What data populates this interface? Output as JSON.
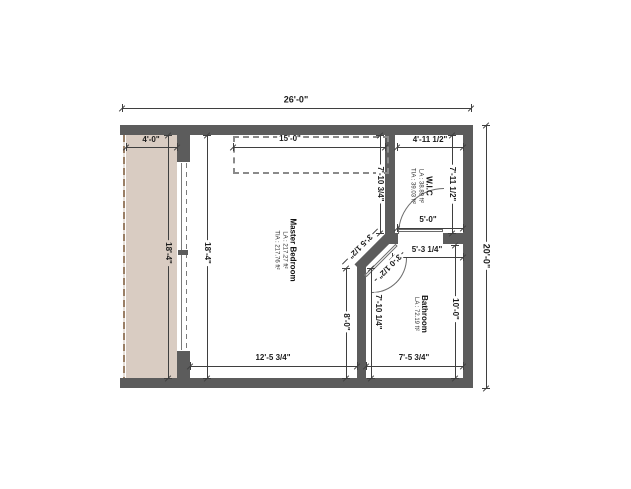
{
  "plan": {
    "canvas": {
      "w": 631,
      "h": 489
    },
    "colors": {
      "wall": "#5c5c5c",
      "balcony_fill": "#d9ccc2",
      "railing": "#9a7f66",
      "dim_line": "#3f3f3f",
      "text": "#1b1b1b",
      "background": "#ffffff"
    },
    "overall": {
      "width_label": "26'-0\"",
      "height_label": "20'-0\""
    },
    "rooms": [
      {
        "id": "master-bedroom",
        "title": "Master Bedroom",
        "areas": [
          "LA : 217.27 ft²",
          "TIA : 217.76 ft²"
        ],
        "cx": 285,
        "cy": 250
      },
      {
        "id": "wic",
        "title": "W.I.C",
        "areas": [
          "LA : 38.89 ft²",
          "TIA : 39.03 ft²"
        ],
        "cx": 421,
        "cy": 186
      },
      {
        "id": "bathroom",
        "title": "Bathroom",
        "areas": [
          "LA : 72.19 ft²"
        ],
        "cx": 420,
        "cy": 314
      }
    ],
    "balcony": {
      "x": 126,
      "y": 135,
      "w": 51,
      "h": 243,
      "railing_x": 123
    },
    "closet_outline": {
      "x": 233,
      "y": 136,
      "w": 152,
      "h": 34
    },
    "walls": [
      {
        "x": 120,
        "y": 125,
        "w": 353,
        "h": 10
      },
      {
        "x": 120,
        "y": 378,
        "w": 353,
        "h": 10
      },
      {
        "x": 463,
        "y": 135,
        "w": 10,
        "h": 243
      },
      {
        "x": 177,
        "y": 135,
        "w": 13,
        "h": 27
      },
      {
        "x": 177,
        "y": 351,
        "w": 13,
        "h": 27
      },
      {
        "x": 385,
        "y": 135,
        "w": 10,
        "h": 98
      },
      {
        "x": 385,
        "y": 233,
        "w": 13,
        "h": 11
      },
      {
        "x": 443,
        "y": 233,
        "w": 20,
        "h": 11
      },
      {
        "x": 351,
        "y": 246,
        "w": 48,
        "h": 10,
        "rot": -45
      },
      {
        "x": 357,
        "y": 262,
        "w": 9,
        "h": 116
      }
    ],
    "slider": {
      "open_x": 177,
      "open_y": 162,
      "open_w": 13,
      "open_h": 189,
      "track1_x": 181,
      "track2_x": 186,
      "handle": {
        "x": 178,
        "y": 250,
        "w": 10,
        "h": 5
      }
    },
    "wic_door": {
      "arc": {
        "x": 398,
        "y": 188,
        "w": 45,
        "h": 45,
        "corner": "tl"
      },
      "leaf": {
        "x": 398,
        "y": 229,
        "w": 45,
        "h": 3
      }
    },
    "bath_door": {
      "arc": {
        "x": 372,
        "y": 258,
        "w": 34,
        "h": 34,
        "corner": "br"
      },
      "leaf": {
        "x": 359,
        "y": 259,
        "w": 44,
        "h": 3,
        "rot": -45
      }
    },
    "dims": [
      {
        "label": "26'-0\"",
        "type": "h",
        "x1": 122,
        "x2": 471,
        "y": 108,
        "lx": 296,
        "ly": 100,
        "big": true
      },
      {
        "label": "20'-0\"",
        "type": "v",
        "x": 486,
        "y1": 125,
        "y2": 388,
        "lx": 486,
        "ly": 256,
        "big": true
      },
      {
        "label": "4'-0\"",
        "type": "h",
        "x1": 126,
        "x2": 177,
        "y": 147,
        "lx": 151,
        "ly": 140,
        "bg": "#d9ccc2"
      },
      {
        "label": "18'-4\"",
        "type": "v",
        "x": 168,
        "y1": 135,
        "y2": 378,
        "lx": 168,
        "ly": 253,
        "bg": "#d9ccc2"
      },
      {
        "label": "18'-4\"",
        "type": "v",
        "x": 207,
        "y1": 135,
        "y2": 378,
        "lx": 207,
        "ly": 253
      },
      {
        "label": "15'-0\"",
        "type": "h",
        "x1": 233,
        "x2": 385,
        "y": 147,
        "lx": 290,
        "ly": 139
      },
      {
        "label": "7'-10 3/4\"",
        "type": "v",
        "x": 380,
        "y1": 135,
        "y2": 233,
        "lx": 380,
        "ly": 184
      },
      {
        "label": "4'-11 1/2\"",
        "type": "h",
        "x1": 397,
        "x2": 463,
        "y": 147,
        "lx": 430,
        "ly": 140
      },
      {
        "label": "7'-11 1/2\"",
        "type": "v",
        "x": 452,
        "y1": 135,
        "y2": 233,
        "lx": 452,
        "ly": 184
      },
      {
        "label": "5'-0\"",
        "type": "h",
        "x1": 397,
        "x2": 463,
        "y": 228,
        "lx": 428,
        "ly": 220
      },
      {
        "label": "5'-3 1/4\"",
        "type": "h",
        "x1": 392,
        "x2": 463,
        "y": 257,
        "lx": 427,
        "ly": 250
      },
      {
        "label": "10'-0\"",
        "type": "v",
        "x": 455,
        "y1": 245,
        "y2": 378,
        "lx": 455,
        "ly": 309
      },
      {
        "label": "7'-10 1/4\"",
        "type": "v",
        "x": 371,
        "y1": 268,
        "y2": 378,
        "lx": 378,
        "ly": 312
      },
      {
        "label": "8'-0\"",
        "type": "v",
        "x": 346,
        "y1": 268,
        "y2": 378,
        "lx": 346,
        "ly": 322
      },
      {
        "label": "12'-5 3/4\"",
        "type": "h",
        "x1": 190,
        "x2": 357,
        "y": 366,
        "lx": 273,
        "ly": 358
      },
      {
        "label": "7'-5 3/4\"",
        "type": "h",
        "x1": 366,
        "x2": 463,
        "y": 366,
        "lx": 414,
        "ly": 358
      },
      {
        "label": "3'-5 1/2\"",
        "type": "d",
        "cx": 360,
        "cy": 246,
        "len": 50,
        "lx": 360,
        "ly": 246
      },
      {
        "label": "3'-0 1/2\"",
        "type": "d",
        "cx": 389,
        "cy": 266,
        "len": 40,
        "lx": 389,
        "ly": 266
      }
    ]
  }
}
